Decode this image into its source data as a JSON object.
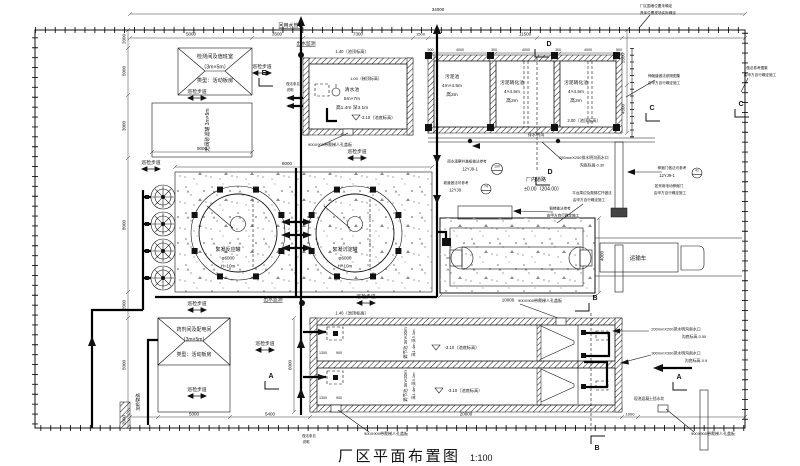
{
  "drawing": {
    "title": "厂区平面布置图",
    "scale": "1:100"
  },
  "colors": {
    "ink": "#111111",
    "paper": "#ffffff",
    "pad_fill": "#fbfbfb",
    "equipment_pad_fill": "#ececec",
    "speckle": "#808080"
  },
  "labels": [
    {
      "n": "dim-total-width",
      "t": "34000",
      "x": 438,
      "y": 11,
      "s": 4.5
    },
    {
      "n": "dim-5000-top",
      "t": "5000",
      "x": 191,
      "y": 35.5,
      "s": 4.5
    },
    {
      "n": "dim-3500-top",
      "t": "3500",
      "x": 277,
      "y": 35.5,
      "s": 4.5
    },
    {
      "n": "dim-7300-top",
      "t": "7300",
      "x": 358,
      "y": 35.5,
      "s": 4.5
    },
    {
      "n": "dim-1500-top",
      "t": "1500",
      "x": 420.5,
      "y": 35.5,
      "s": 4
    },
    {
      "n": "dim-11500-top",
      "t": "11500",
      "x": 525,
      "y": 35.5,
      "s": 4.5
    },
    {
      "n": "dim-cell-500a",
      "t": "500",
      "x": 430.5,
      "y": 51,
      "s": 3.6
    },
    {
      "n": "dim-cell-4000a",
      "t": "4000",
      "x": 460,
      "y": 51,
      "s": 3.6
    },
    {
      "n": "dim-cell-300a",
      "t": "300",
      "x": 494,
      "y": 51,
      "s": 3.6
    },
    {
      "n": "dim-cell-4000b",
      "t": "4000",
      "x": 526,
      "y": 51,
      "s": 3.6
    },
    {
      "n": "dim-cell-300b",
      "t": "300",
      "x": 558,
      "y": 51,
      "s": 3.6
    },
    {
      "n": "dim-cell-4000c",
      "t": "4000",
      "x": 588,
      "y": 51,
      "s": 3.6
    },
    {
      "n": "dim-cell-500b",
      "t": "500",
      "x": 619,
      "y": 51,
      "s": 3.6
    },
    {
      "n": "dim-5500-right",
      "t": "5500",
      "x": 624.5,
      "y": 58,
      "s": 4.5,
      "r": -90
    },
    {
      "n": "dim-4500-right",
      "t": "4500",
      "x": 624.5,
      "y": 109,
      "s": 4.5,
      "r": -90
    },
    {
      "n": "dim-9000-filter",
      "t": "9000",
      "x": 202,
      "y": 150,
      "s": 4.5
    },
    {
      "n": "dim-8000-pad",
      "t": "8000",
      "x": 287,
      "y": 165,
      "s": 4.5
    },
    {
      "n": "dim-10000-dewater",
      "t": "10000",
      "x": 508,
      "y": 301.5,
      "s": 4.5
    },
    {
      "n": "dim-4000-dewater",
      "t": "4000",
      "x": 603.5,
      "y": 256,
      "s": 4.5,
      "r": -90
    },
    {
      "n": "dim-6000-pools",
      "t": "6000",
      "x": 291.5,
      "y": 365,
      "s": 4.5,
      "r": -90
    },
    {
      "n": "dim-5000-bottom",
      "t": "5000",
      "x": 194,
      "y": 415.5,
      "s": 4.5
    },
    {
      "n": "dim-5400-bottom",
      "t": "5400",
      "x": 270,
      "y": 415.5,
      "s": 4.5
    },
    {
      "n": "dim-20000-bottom",
      "t": "20000",
      "x": 466,
      "y": 415.5,
      "s": 4.5
    },
    {
      "n": "dim-1000-bottom",
      "t": "1000",
      "x": 630,
      "y": 415.5,
      "s": 4
    },
    {
      "n": "dim-2000-left-a",
      "t": "2000",
      "x": 125.5,
      "y": 39,
      "s": 4.5,
      "r": -90
    },
    {
      "n": "dim-5000-left",
      "t": "5000",
      "x": 125.5,
      "y": 71,
      "s": 4.5,
      "r": -90
    },
    {
      "n": "dim-3000-left",
      "t": "3000",
      "x": 125.5,
      "y": 126,
      "s": 4.5,
      "r": -90
    },
    {
      "n": "dim-8000-left",
      "t": "8000",
      "x": 125.5,
      "y": 225,
      "s": 4.5,
      "r": -90
    },
    {
      "n": "dim-2000-left-b",
      "t": "2000",
      "x": 125.5,
      "y": 305,
      "s": 4.5,
      "r": -90
    },
    {
      "n": "dim-5000-left-b",
      "t": "5000",
      "x": 125.5,
      "y": 365,
      "s": 4.5,
      "r": -90
    },
    {
      "n": "dim-2000-left-c",
      "t": "2000",
      "x": 125.5,
      "y": 420,
      "s": 4.5,
      "r": -90
    },
    {
      "n": "dim-1300-p1",
      "t": "1300",
      "x": 323,
      "y": 354,
      "s": 3.6
    },
    {
      "n": "dim-900-p1",
      "t": "900",
      "x": 339,
      "y": 354,
      "s": 3.6
    },
    {
      "n": "dim-1300-p2",
      "t": "1300",
      "x": 323,
      "y": 399,
      "s": 3.6
    },
    {
      "n": "dim-900-p2",
      "t": "900",
      "x": 339,
      "y": 399,
      "s": 3.6
    },
    {
      "n": "label-reuse-water-pipe",
      "t": "回用水管路",
      "x": 291,
      "y": 27,
      "s": 5,
      "u": true
    },
    {
      "n": "label-outlet-monitor-top",
      "t": "出水监测",
      "x": 306,
      "y": 45,
      "s": 4.8,
      "u": true
    },
    {
      "n": "label-outlet-monitor-mid",
      "t": "出水监测",
      "x": 273,
      "y": 301,
      "s": 4.8,
      "u": true
    },
    {
      "n": "label-inspection-room-1",
      "t": "检测间及值班室",
      "x": 215,
      "y": 58,
      "s": 5.2
    },
    {
      "n": "label-inspection-room-2",
      "t": "（3m×5m）",
      "x": 215,
      "y": 68.5,
      "s": 5.2
    },
    {
      "n": "label-inspection-room-3",
      "t": "类型：活动板房",
      "x": 215,
      "y": 82,
      "s": 5.2
    },
    {
      "n": "label-sand-filter",
      "t": "无阀砂滤罐 3m×9m",
      "x": 209,
      "y": 130,
      "s": 5,
      "r": -90
    },
    {
      "n": "label-clearwater-1",
      "t": "清水池",
      "x": 352,
      "y": 91,
      "s": 4.8
    },
    {
      "n": "label-clearwater-2",
      "t": "5m×7m",
      "x": 352,
      "y": 100,
      "s": 4.8
    },
    {
      "n": "label-clearwater-3",
      "t": "高1.4m 深3.1m",
      "x": 352,
      "y": 109,
      "s": 4.8
    },
    {
      "n": "label-elev-140-top",
      "t": "1.40（池顶标高）",
      "x": 352,
      "y": 53,
      "s": 4.2
    },
    {
      "n": "label-elev-100-ladder",
      "t": "1.00（梯顶标高）",
      "x": 366,
      "y": 80,
      "s": 4
    },
    {
      "n": "label-elev-310-cwt",
      "t": "-3.10（池底标高）",
      "x": 378,
      "y": 119,
      "s": 4.2
    },
    {
      "n": "label-sludge-pool-1",
      "t": "污泥池",
      "x": 452,
      "y": 78,
      "s": 4.8
    },
    {
      "n": "label-sludge-pool-2",
      "t": "4m×4.5m",
      "x": 452,
      "y": 87,
      "s": 4.8
    },
    {
      "n": "label-sludge-pool-3",
      "t": "高2m",
      "x": 452,
      "y": 96,
      "s": 4.8
    },
    {
      "n": "label-digestion1-1",
      "t": "污泥硝化池",
      "x": 512,
      "y": 84,
      "s": 4.8
    },
    {
      "n": "label-digestion1-2",
      "t": "4×4.5m",
      "x": 512,
      "y": 93,
      "s": 4.8
    },
    {
      "n": "label-digestion1-3",
      "t": "高2m",
      "x": 512,
      "y": 102,
      "s": 4.8
    },
    {
      "n": "label-digestion2-1",
      "t": "污泥硝化池",
      "x": 576,
      "y": 84,
      "s": 4.8
    },
    {
      "n": "label-digestion2-2",
      "t": "4×4.5m",
      "x": 576,
      "y": 93,
      "s": 4.8
    },
    {
      "n": "label-digestion2-3",
      "t": "高2m",
      "x": 576,
      "y": 102,
      "s": 4.8
    },
    {
      "n": "label-elev-200",
      "t": "2.00（池顶标高）",
      "x": 584,
      "y": 122,
      "s": 4.2
    },
    {
      "n": "label-drain-channel",
      "t": "排水明沟",
      "x": 536,
      "y": 136,
      "s": 4.2
    },
    {
      "n": "label-gutter-250",
      "t": "250mmX250排水明沟雨水口",
      "x": 584,
      "y": 159,
      "s": 3.9
    },
    {
      "n": "label-gutter-250-elev",
      "t": "沟底标高-0.30",
      "x": 592,
      "y": 166.5,
      "s": 3.9
    },
    {
      "n": "label-tank1-1",
      "t": "絮凝反应罐",
      "x": 228,
      "y": 251,
      "s": 5
    },
    {
      "n": "label-tank1-2",
      "t": "φ6000",
      "x": 228,
      "y": 259.5,
      "s": 4.5
    },
    {
      "n": "label-tank1-3",
      "t": "H=10m",
      "x": 228,
      "y": 267.5,
      "s": 4.5
    },
    {
      "n": "label-tank2-1",
      "t": "絮凝沉淀罐",
      "x": 345,
      "y": 251,
      "s": 5
    },
    {
      "n": "label-tank2-2",
      "t": "φ6000",
      "x": 345,
      "y": 259.5,
      "s": 4.5
    },
    {
      "n": "label-tank2-3",
      "t": "H=10m",
      "x": 345,
      "y": 267.5,
      "s": 4.5
    },
    {
      "n": "note-rain-well",
      "t": "雨水观察井盖板做法参考",
      "x": 467,
      "y": 162.5,
      "s": 3.6
    },
    {
      "n": "code-rain-well",
      "t": "12YJ9-1",
      "x": 470,
      "y": 170.5,
      "s": 4.2
    },
    {
      "n": "sym-100",
      "t": "100",
      "x": 497,
      "y": 167.5,
      "s": 3.4
    },
    {
      "n": "note-ramp",
      "t": "坡道做法可参考",
      "x": 456,
      "y": 184,
      "s": 3.6
    },
    {
      "n": "code-ramp",
      "t": "12YJ8",
      "x": 455,
      "y": 191.5,
      "s": 4.2
    },
    {
      "n": "sym-74",
      "t": "74",
      "x": 486,
      "y": 187.5,
      "s": 3.4
    },
    {
      "n": "label-road",
      "t": "厂内道路",
      "x": 536,
      "y": 181,
      "s": 5
    },
    {
      "n": "label-road-elev",
      "t": "±0.00（204.00）",
      "x": 543,
      "y": 190.5,
      "s": 5
    },
    {
      "n": "note-platform-1",
      "t": "平台周边及爬梯栏杆做法",
      "x": 592,
      "y": 194,
      "s": 3.6
    },
    {
      "n": "note-platform-2",
      "t": "由甲方自行确定施工",
      "x": 589,
      "y": 201,
      "s": 3.6
    },
    {
      "n": "note-stair-1",
      "t": "钢梯做法参考",
      "x": 560,
      "y": 209.5,
      "s": 3.6
    },
    {
      "n": "note-stair-2",
      "t": "由甲方自行确定施工",
      "x": 563,
      "y": 216.5,
      "s": 3.6
    },
    {
      "n": "note-gate-1",
      "t": "伸缩门做法可参考",
      "x": 672,
      "y": 169,
      "s": 3.6
    },
    {
      "n": "code-gate",
      "t": "12YJ9-1",
      "x": 667,
      "y": 177,
      "s": 4.2
    },
    {
      "n": "sym-41",
      "t": "41",
      "x": 697,
      "y": 171.5,
      "s": 3.4
    },
    {
      "n": "note-egate-1",
      "t": "如采用电动伸缩门",
      "x": 669,
      "y": 187,
      "s": 3.6
    },
    {
      "n": "note-egate-2",
      "t": "由甲方自行确定施工",
      "x": 670,
      "y": 194,
      "s": 3.6
    },
    {
      "n": "label-truck",
      "t": "运输车",
      "x": 638,
      "y": 260,
      "s": 5.5
    },
    {
      "n": "note-fence-1",
      "t": "厂区围墙位置未确定",
      "x": 656,
      "y": 7,
      "s": 3.6
    },
    {
      "n": "note-fence-2",
      "t": "具体位置现场实际确定",
      "x": 658,
      "y": 14,
      "s": 3.6
    },
    {
      "n": "note-joint-1",
      "t": "伸缩缝做法参照图集",
      "x": 664,
      "y": 77,
      "s": 3.6
    },
    {
      "n": "note-joint-2",
      "t": "由甲方自行确定施工",
      "x": 664,
      "y": 84,
      "s": 3.6
    },
    {
      "n": "note-right-1",
      "t": "做法参考图集",
      "x": 757,
      "y": 69,
      "s": 3.6
    },
    {
      "n": "note-right-2",
      "t": "由甲方自行确定施工",
      "x": 760,
      "y": 76,
      "s": 3.6
    },
    {
      "n": "label-walkway-1",
      "t": "巡检步道",
      "x": 151,
      "y": 164,
      "s": 4.8
    },
    {
      "n": "label-walkway-2",
      "t": "巡检步道",
      "x": 197,
      "y": 93,
      "s": 4.8
    },
    {
      "n": "label-walkway-3",
      "t": "巡检步道",
      "x": 262,
      "y": 68,
      "s": 4.8
    },
    {
      "n": "label-walkway-4",
      "t": "巡检步道",
      "x": 197,
      "y": 305,
      "s": 4.8
    },
    {
      "n": "label-walkway-5",
      "t": "巡检步道",
      "x": 366,
      "y": 298,
      "s": 4.8
    },
    {
      "n": "label-walkway-6",
      "t": "巡检步道",
      "x": 265,
      "y": 345,
      "s": 4.8
    },
    {
      "n": "label-walkway-7",
      "t": "巡检步道",
      "x": 197,
      "y": 391,
      "s": 4.8
    },
    {
      "n": "label-walkway-8",
      "t": "巡检步道",
      "x": 357,
      "y": 153,
      "s": 4.8
    },
    {
      "n": "label-reg-pool-1a",
      "t": "调节池 3m×20m",
      "x": 407,
      "y": 343,
      "s": 4.4,
      "r": -90
    },
    {
      "n": "label-reg-pool-1b",
      "t": "高1.4m 深3.1m",
      "x": 415,
      "y": 343,
      "s": 4,
      "r": -90
    },
    {
      "n": "label-reg-pool-2a",
      "t": "调节池 3m×20m",
      "x": 407,
      "y": 386,
      "s": 4.4,
      "r": -90
    },
    {
      "n": "label-reg-pool-2b",
      "t": "高1.4m 深3.1m",
      "x": 415,
      "y": 386,
      "s": 4,
      "r": -90
    },
    {
      "n": "label-elev-310-p1",
      "t": "-3.10（池底标高）",
      "x": 462,
      "y": 349,
      "s": 4.2
    },
    {
      "n": "label-elev-310-p2",
      "t": "-3.10（池底标高）",
      "x": 465,
      "y": 392,
      "s": 4.2
    },
    {
      "n": "label-elev-140-pools",
      "t": "1.40（池顶标高）",
      "x": 352,
      "y": 314.5,
      "s": 4.2
    },
    {
      "n": "label-chemical-room-1",
      "t": "药剂间及配电间",
      "x": 194,
      "y": 331,
      "s": 5
    },
    {
      "n": "label-chemical-room-2",
      "t": "（3m×5m）",
      "x": 194,
      "y": 341,
      "s": 5
    },
    {
      "n": "label-chemical-room-3",
      "t": "类型：活动板房",
      "x": 194,
      "y": 356,
      "s": 5
    },
    {
      "n": "label-dosing-pipe",
      "t": "加药管路",
      "x": 139.5,
      "y": 402,
      "s": 4.4,
      "r": -90
    },
    {
      "n": "label-manhole-1",
      "t": "900X900带爬梯人孔盖板",
      "x": 330,
      "y": 146,
      "s": 4
    },
    {
      "n": "label-manhole-2",
      "t": "900X900带爬梯人孔盖板",
      "x": 540,
      "y": 302,
      "s": 4
    },
    {
      "n": "label-manhole-3",
      "t": "900X900带爬梯人孔盖板",
      "x": 386,
      "y": 435,
      "s": 4
    },
    {
      "n": "label-manhole-4",
      "t": "900X900带爬梯人孔盖板",
      "x": 713,
      "y": 435,
      "s": 4
    },
    {
      "n": "label-gutter-200",
      "t": "200mmX200排水明沟雨水口",
      "x": 676,
      "y": 330.5,
      "s": 3.9
    },
    {
      "n": "label-gutter-200-elev",
      "t": "沟底标高-0.50",
      "x": 694,
      "y": 338,
      "s": 3.9
    },
    {
      "n": "label-gutter-300",
      "t": "300mmX300排水明沟雨水口",
      "x": 676,
      "y": 354.5,
      "s": 3.9
    },
    {
      "n": "label-gutter-300-elev",
      "t": "沟底标高-0.9",
      "x": 696,
      "y": 362,
      "s": 3.9
    },
    {
      "n": "note-water-stop",
      "t": "现浇混凝土挡水坎",
      "x": 649,
      "y": 400,
      "s": 3.8
    },
    {
      "n": "note-e-1",
      "t": "做法参见",
      "x": 293,
      "y": 85,
      "s": 3.4
    },
    {
      "n": "note-e-2",
      "t": "说明",
      "x": 290,
      "y": 91,
      "s": 3.4
    },
    {
      "n": "note-bl-1",
      "t": "做法参见",
      "x": 309,
      "y": 437,
      "s": 3.4
    },
    {
      "n": "note-bl-2",
      "t": "说明",
      "x": 306,
      "y": 443,
      "s": 3.4
    },
    {
      "n": "marker-section-d-top",
      "t": "D",
      "x": 549,
      "y": 46,
      "s": 7,
      "w": true
    },
    {
      "n": "marker-section-d-mid",
      "t": "D",
      "x": 550,
      "y": 174,
      "s": 7,
      "w": true
    },
    {
      "n": "marker-section-c-1",
      "t": "C",
      "x": 652,
      "y": 110,
      "s": 7,
      "w": true
    },
    {
      "n": "marker-section-c-2",
      "t": "C",
      "x": 741,
      "y": 106,
      "s": 7,
      "w": true
    },
    {
      "n": "marker-section-e",
      "t": "E",
      "x": 264,
      "y": 75,
      "s": 7,
      "w": true
    },
    {
      "n": "marker-section-a-left",
      "t": "A",
      "x": 271,
      "y": 378,
      "s": 7,
      "w": true
    },
    {
      "n": "marker-section-a-right",
      "t": "A",
      "x": 679,
      "y": 379,
      "s": 7,
      "w": true
    },
    {
      "n": "marker-section-b-top",
      "t": "B",
      "x": 595,
      "y": 300,
      "s": 7,
      "w": true
    },
    {
      "n": "marker-section-b-bottom",
      "t": "B",
      "x": 597,
      "y": 450,
      "s": 7,
      "w": true
    }
  ],
  "walkway_arrows": [
    [
      151,
      169
    ],
    [
      197,
      98
    ],
    [
      262,
      73
    ],
    [
      197,
      310
    ],
    [
      366,
      303
    ],
    [
      265,
      350
    ],
    [
      197,
      396
    ],
    [
      357,
      158
    ]
  ]
}
